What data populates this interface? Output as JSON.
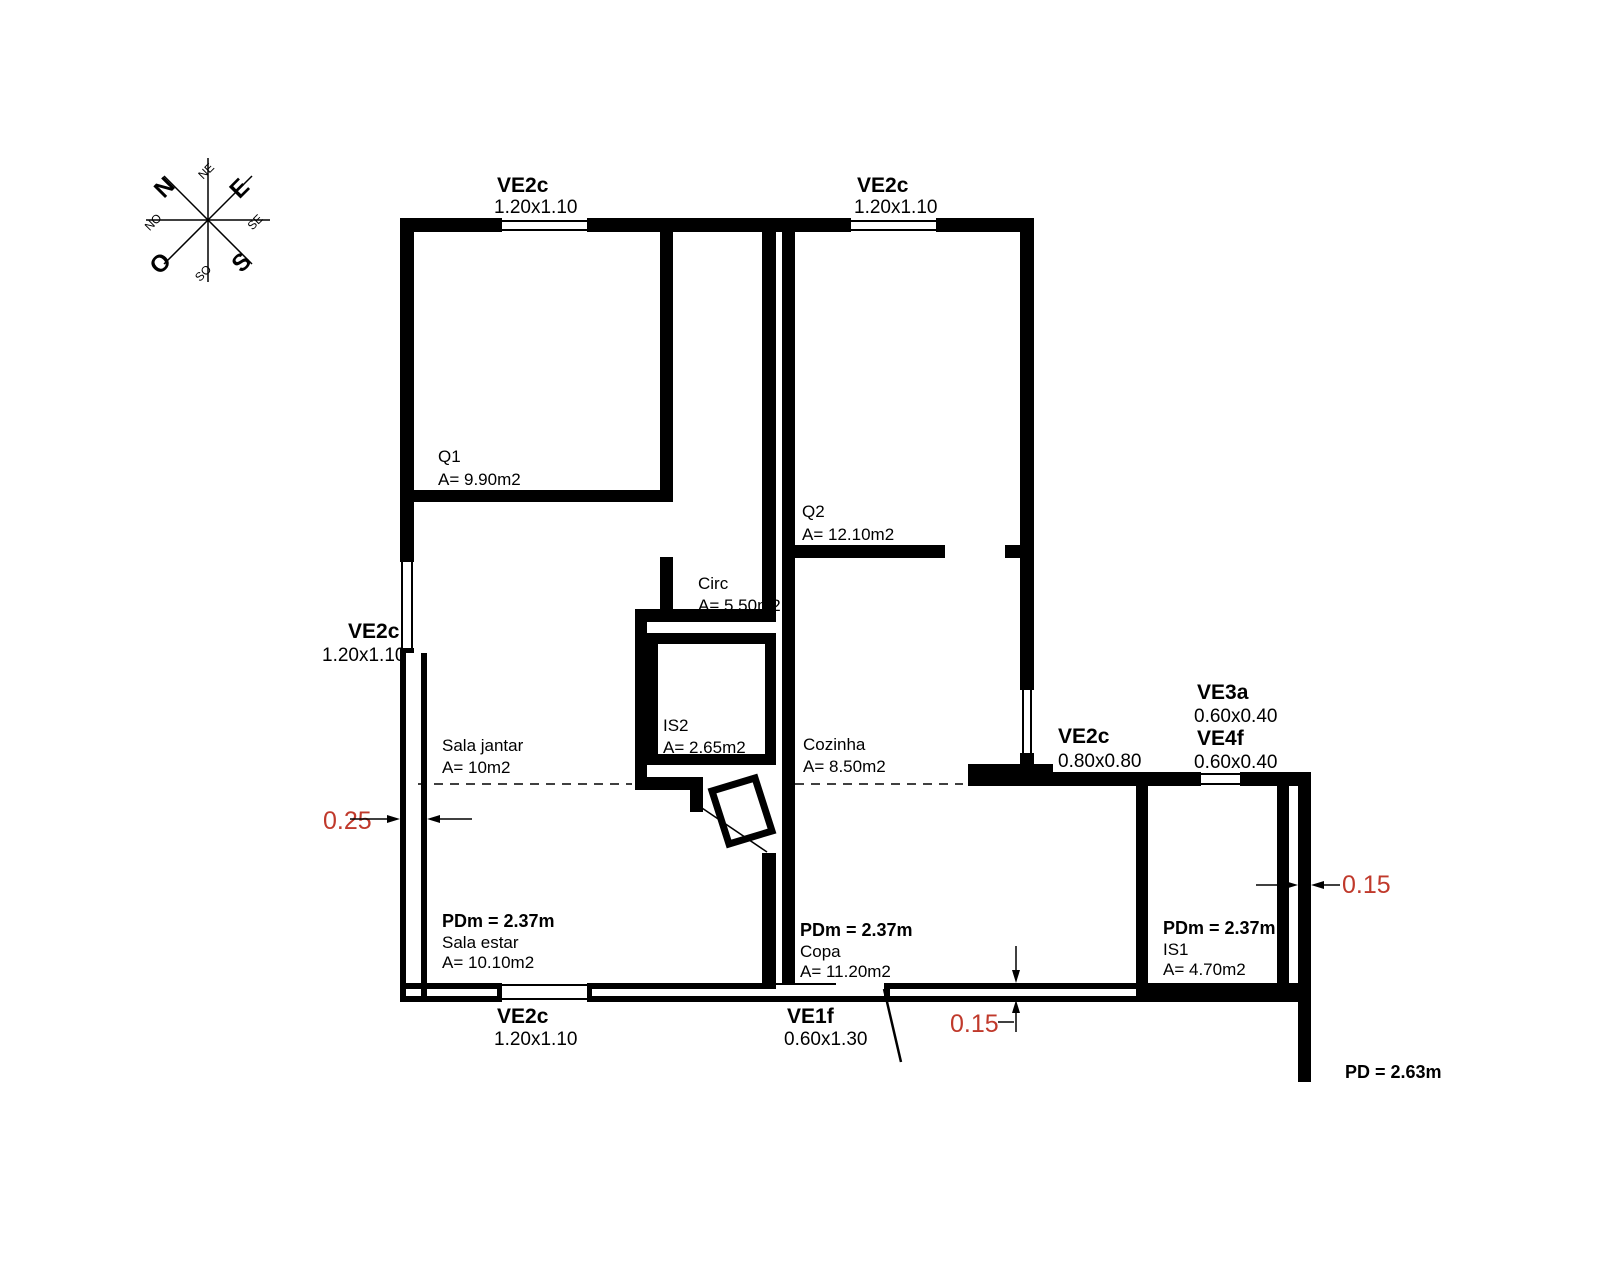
{
  "colors": {
    "dimension_red": "#c0392b",
    "line_black": "#000000"
  },
  "compass": {
    "cardinals": {
      "n": "N",
      "e": "E",
      "s": "S",
      "o": "O"
    },
    "intercardinals": {
      "ne": "NE",
      "se": "SE",
      "so": "SO",
      "no": "NO"
    }
  },
  "windows": {
    "top_left": {
      "name": "VE2c",
      "size": "1.20x1.10"
    },
    "top_right": {
      "name": "VE2c",
      "size": "1.20x1.10"
    },
    "left": {
      "name": "VE2c",
      "size": "1.20x1.10"
    },
    "bottom": {
      "name": "VE2c",
      "size": "1.20x1.10"
    },
    "entry_door": {
      "name": "VE1f",
      "size": "0.60x1.30"
    },
    "east_mid": {
      "name": "VE2c",
      "size": "0.80x0.80"
    },
    "ve3a": {
      "name": "VE3a",
      "size": "0.60x0.40"
    },
    "ve4f": {
      "name": "VE4f",
      "size": "0.60x0.40"
    }
  },
  "rooms": {
    "q1": {
      "name": "Q1",
      "area": "A= 9.90m2"
    },
    "q2": {
      "name": "Q2",
      "area": "A= 12.10m2"
    },
    "circ": {
      "name": "Circ",
      "area": "A= 5.50m2"
    },
    "is2": {
      "name": "IS2",
      "area": "A= 2.65m2"
    },
    "sala_jantar": {
      "name": "Sala jantar",
      "area": "A= 10m2"
    },
    "cozinha": {
      "name": "Cozinha",
      "area": "A= 8.50m2"
    },
    "sala_estar": {
      "pdm": "PDm = 2.37m",
      "name": "Sala estar",
      "area": "A= 10.10m2"
    },
    "copa": {
      "pdm": "PDm = 2.37m",
      "name": "Copa",
      "area": "A= 11.20m2"
    },
    "is1": {
      "pdm": "PDm = 2.37m",
      "name": "IS1",
      "area": "A= 4.70m2"
    }
  },
  "dimensions": {
    "left_wall": "0.25",
    "right_wall": "0.15",
    "bottom_wall": "0.15"
  },
  "notes": {
    "pd": "PD = 2.63m"
  }
}
